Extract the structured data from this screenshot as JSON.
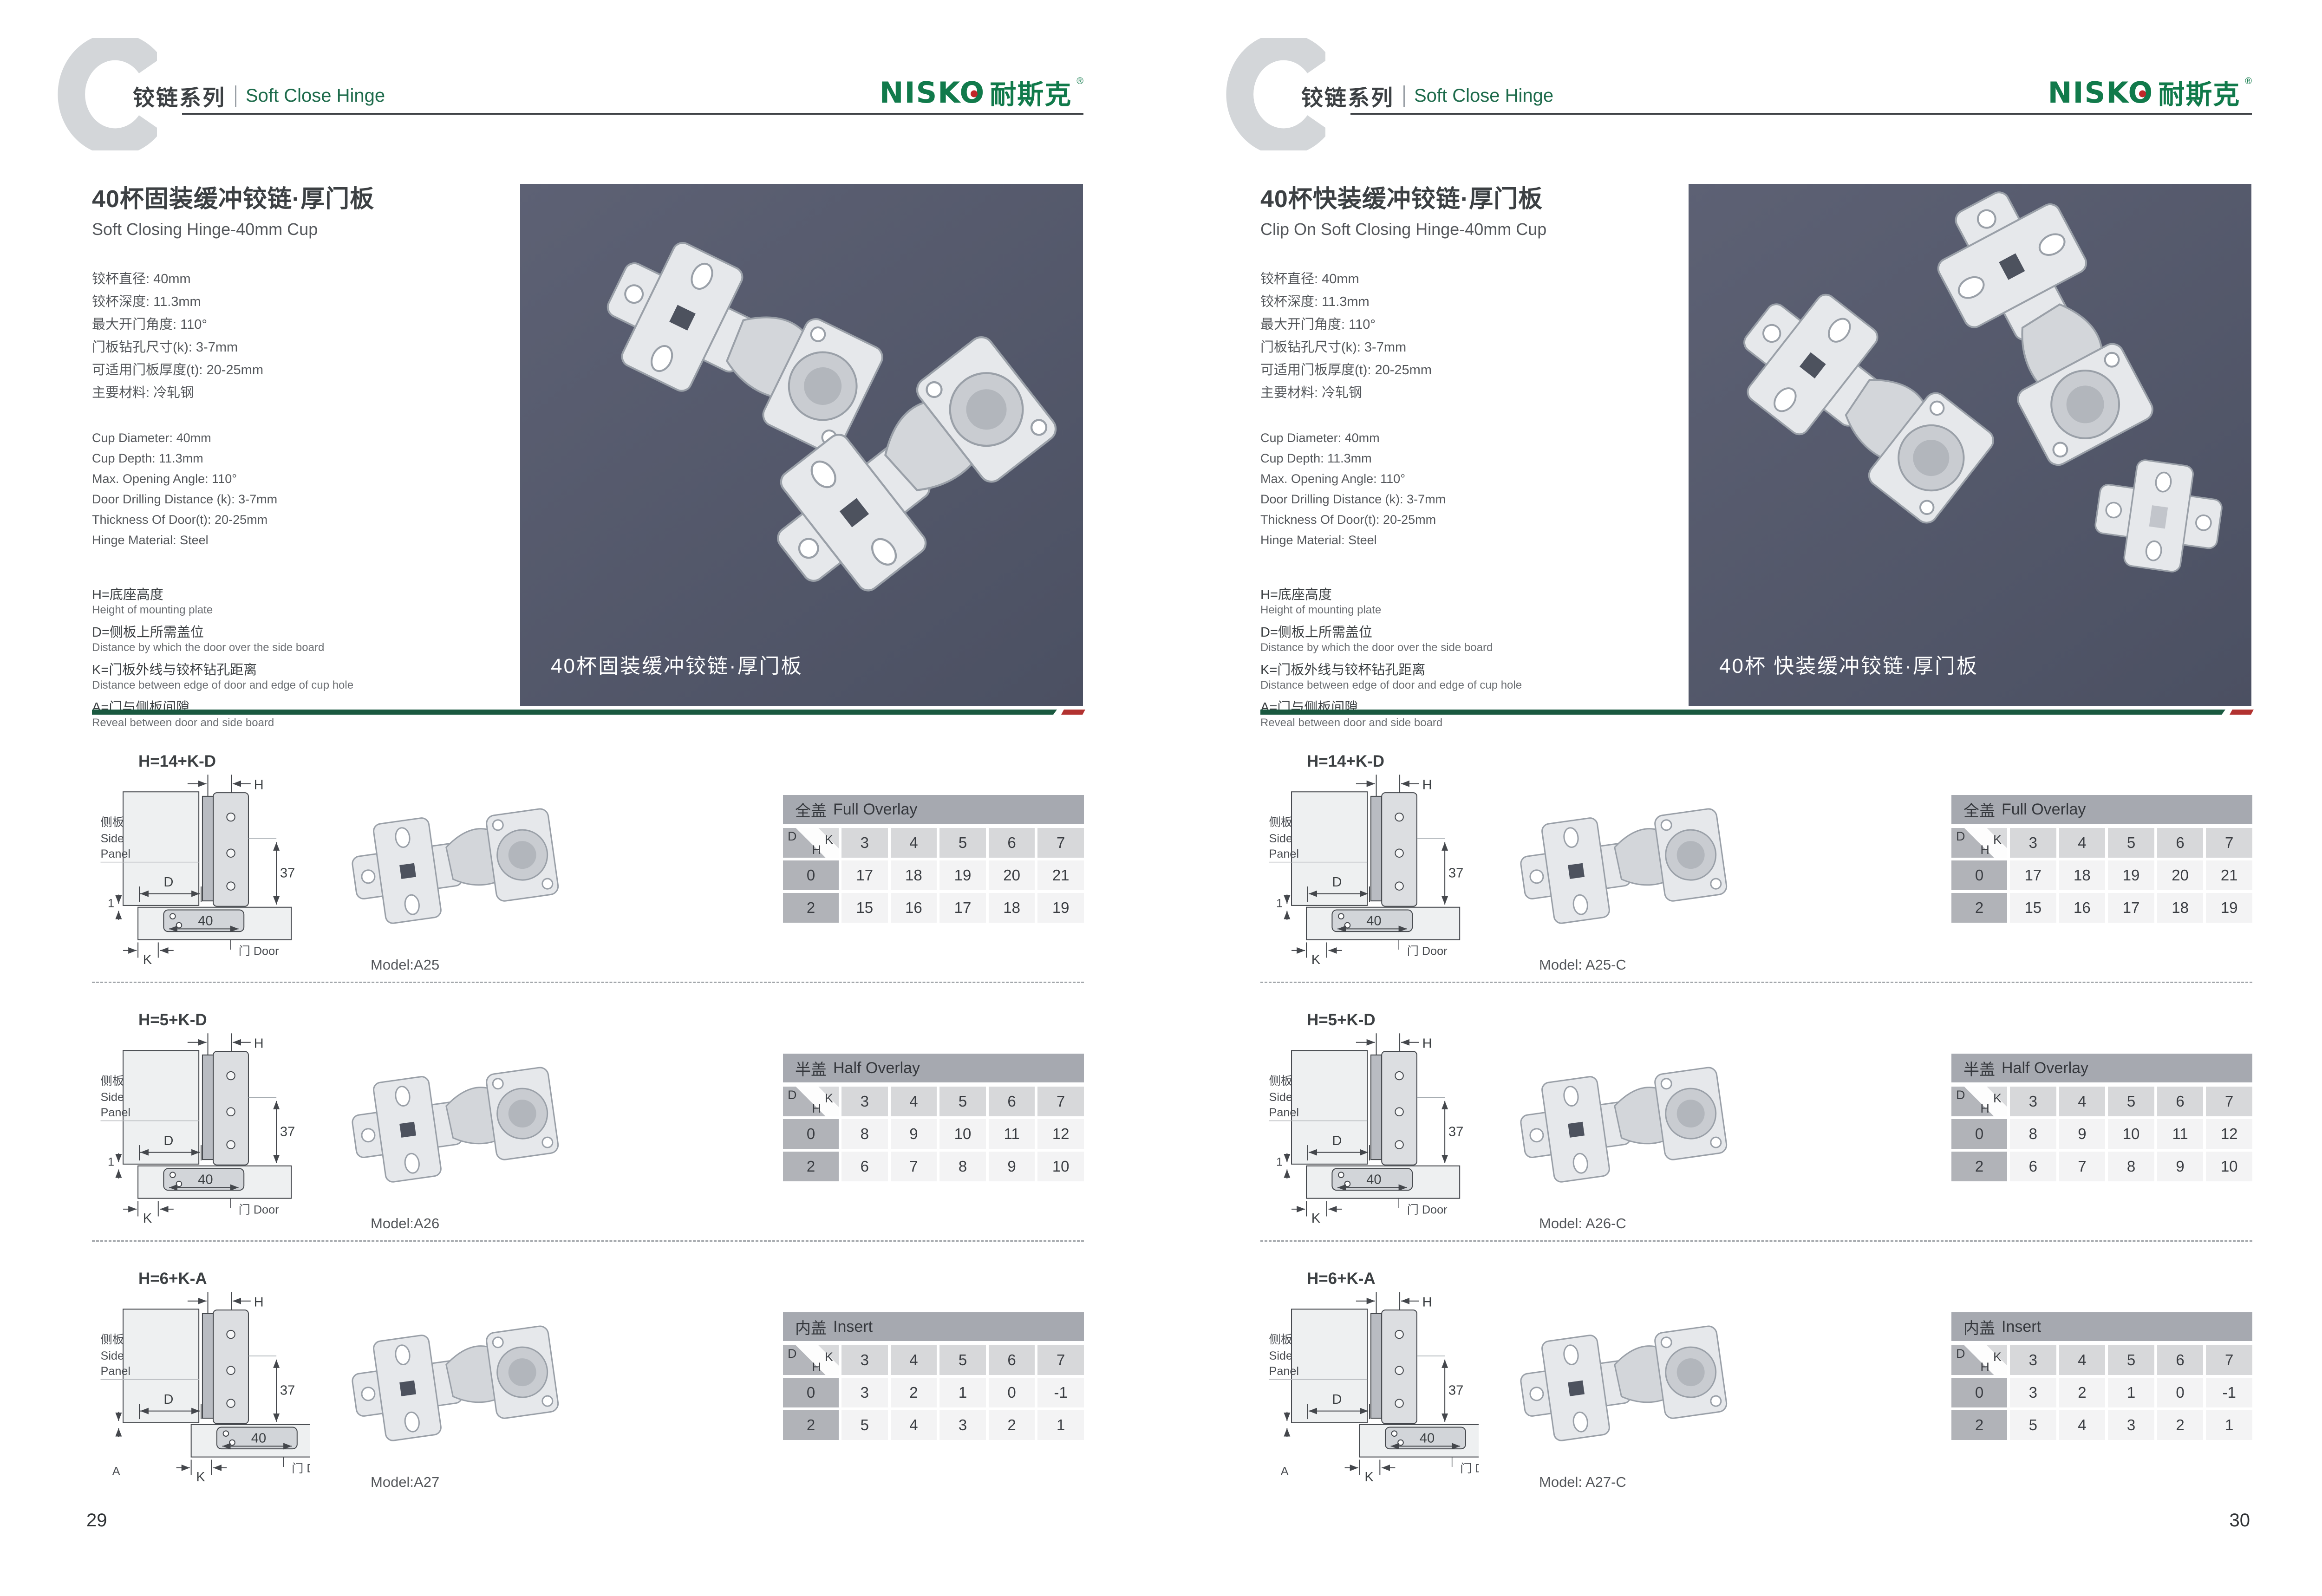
{
  "header": {
    "series_cn": "铰链系列",
    "series_en": "Soft Close Hinge"
  },
  "brand": {
    "latin": "NISKO",
    "cn": "耐斯克",
    "reg": "®"
  },
  "diagram_labels": {
    "h": "H",
    "d": "D",
    "k": "K",
    "side_cn": "侧板",
    "side_en1": "Side",
    "side_en2": "Panel",
    "door": "门 Door",
    "dim37": "37",
    "dim40": "40"
  },
  "pages": [
    {
      "title_cn": "40杯固装缓冲铰链·厚门板",
      "title_en": "Soft Closing Hinge-40mm Cup",
      "specs_cn": [
        "铰杯直径: 40mm",
        "铰杯深度: 11.3mm",
        "最大开门角度: 110°",
        "门板钻孔尺寸(k): 3-7mm",
        "可适用门板厚度(t): 20-25mm",
        "主要材料: 冷轧钢"
      ],
      "specs_en": [
        "Cup Diameter: 40mm",
        "Cup Depth: 11.3mm",
        "Max. Opening Angle: 110°",
        "Door Drilling Distance (k): 3-7mm",
        "Thickness Of Door(t): 20-25mm",
        "Hinge Material: Steel"
      ],
      "defs": [
        {
          "term": "H=底座高度",
          "desc": "Height of mounting plate"
        },
        {
          "term": "D=侧板上所需盖位",
          "desc": "Distance by which the door over the side board"
        },
        {
          "term": "K=门板外线与铰杯钻孔距离",
          "desc": "Distance between edge of door and edge of cup hole"
        },
        {
          "term": "A=门与侧板间隙",
          "desc": "Reveal between door and side board"
        }
      ],
      "photo_caption": "40杯固装缓冲铰链·厚门板",
      "rows": [
        {
          "formula": "H=14+K-D",
          "dim_label": "1",
          "inset": false,
          "model": "Model:A25",
          "table": {
            "title_cn": "全盖",
            "title_en": "Full Overlay",
            "k": [
              3,
              4,
              5,
              6,
              7
            ],
            "rows": [
              {
                "h": 0,
                "values": [
                  17,
                  18,
                  19,
                  20,
                  21
                ]
              },
              {
                "h": 2,
                "values": [
                  15,
                  16,
                  17,
                  18,
                  19
                ]
              }
            ]
          }
        },
        {
          "formula": "H=5+K-D",
          "dim_label": "1",
          "inset": false,
          "model": "Model:A26",
          "table": {
            "title_cn": "半盖",
            "title_en": "Half Overlay",
            "k": [
              3,
              4,
              5,
              6,
              7
            ],
            "rows": [
              {
                "h": 0,
                "values": [
                  8,
                  9,
                  10,
                  11,
                  12
                ]
              },
              {
                "h": 2,
                "values": [
                  6,
                  7,
                  8,
                  9,
                  10
                ]
              }
            ]
          }
        },
        {
          "formula": "H=6+K-A",
          "dim_label": "A",
          "inset": true,
          "model": "Model:A27",
          "table": {
            "title_cn": "内盖",
            "title_en": "Insert",
            "k": [
              3,
              4,
              5,
              6,
              7
            ],
            "rows": [
              {
                "h": 0,
                "values": [
                  3,
                  2,
                  1,
                  0,
                  -1
                ]
              },
              {
                "h": 2,
                "values": [
                  5,
                  4,
                  3,
                  2,
                  1
                ]
              }
            ]
          }
        }
      ],
      "page_number": "29"
    },
    {
      "title_cn": "40杯快装缓冲铰链·厚门板",
      "title_en": "Clip On Soft Closing Hinge-40mm Cup",
      "specs_cn": [
        "铰杯直径: 40mm",
        "铰杯深度: 11.3mm",
        "最大开门角度: 110°",
        "门板钻孔尺寸(k): 3-7mm",
        "可适用门板厚度(t): 20-25mm",
        "主要材料: 冷轧钢"
      ],
      "specs_en": [
        "Cup Diameter: 40mm",
        "Cup Depth: 11.3mm",
        "Max. Opening Angle: 110°",
        "Door Drilling Distance (k): 3-7mm",
        "Thickness Of Door(t): 20-25mm",
        "Hinge Material: Steel"
      ],
      "defs": [
        {
          "term": "H=底座高度",
          "desc": "Height of mounting plate"
        },
        {
          "term": "D=侧板上所需盖位",
          "desc": "Distance by which the door over the side board"
        },
        {
          "term": "K=门板外线与铰杯钻孔距离",
          "desc": "Distance between edge of door and edge of cup hole"
        },
        {
          "term": "A=门与侧板间隙",
          "desc": "Reveal between door and side board"
        }
      ],
      "photo_caption": "40杯 快装缓冲铰链·厚门板",
      "rows": [
        {
          "formula": "H=14+K-D",
          "dim_label": "1",
          "inset": false,
          "model": "Model: A25-C",
          "table": {
            "title_cn": "全盖",
            "title_en": "Full Overlay",
            "k": [
              3,
              4,
              5,
              6,
              7
            ],
            "rows": [
              {
                "h": 0,
                "values": [
                  17,
                  18,
                  19,
                  20,
                  21
                ]
              },
              {
                "h": 2,
                "values": [
                  15,
                  16,
                  17,
                  18,
                  19
                ]
              }
            ]
          }
        },
        {
          "formula": "H=5+K-D",
          "dim_label": "1",
          "inset": false,
          "model": "Model: A26-C",
          "table": {
            "title_cn": "半盖",
            "title_en": "Half Overlay",
            "k": [
              3,
              4,
              5,
              6,
              7
            ],
            "rows": [
              {
                "h": 0,
                "values": [
                  8,
                  9,
                  10,
                  11,
                  12
                ]
              },
              {
                "h": 2,
                "values": [
                  6,
                  7,
                  8,
                  9,
                  10
                ]
              }
            ]
          }
        },
        {
          "formula": "H=6+K-A",
          "dim_label": "A",
          "inset": true,
          "model": "Model: A27-C",
          "table": {
            "title_cn": "内盖",
            "title_en": "Insert",
            "k": [
              3,
              4,
              5,
              6,
              7
            ],
            "rows": [
              {
                "h": 0,
                "values": [
                  3,
                  2,
                  1,
                  0,
                  -1
                ]
              },
              {
                "h": 2,
                "values": [
                  5,
                  4,
                  3,
                  2,
                  1
                ]
              }
            ]
          }
        }
      ],
      "page_number": "30"
    }
  ]
}
